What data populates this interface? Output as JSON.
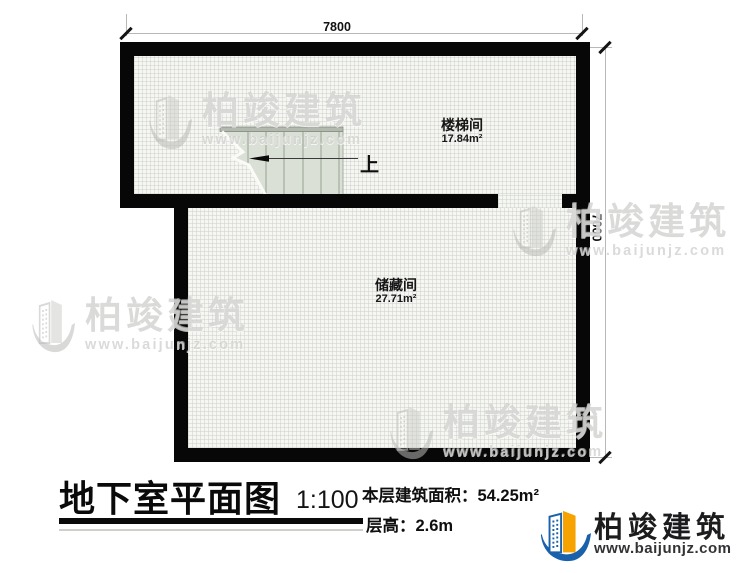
{
  "plan": {
    "dimensions": {
      "top": "7800",
      "right": "7000"
    },
    "rooms": [
      {
        "name": "楼梯间",
        "area": "17.84m²"
      },
      {
        "name": "储藏间",
        "area": "27.71m²"
      }
    ],
    "stair": {
      "direction_label": "上"
    }
  },
  "title_block": {
    "title": "地下室平面图",
    "scale": "1:100",
    "floor_area": "本层建筑面积：54.25m²",
    "floor_height": "层高：2.6m"
  },
  "brand": {
    "name": "柏竣建筑",
    "website": "www.baijunjz.com",
    "colors": {
      "blue": "#1961ab",
      "orange": "#f6a200"
    }
  }
}
